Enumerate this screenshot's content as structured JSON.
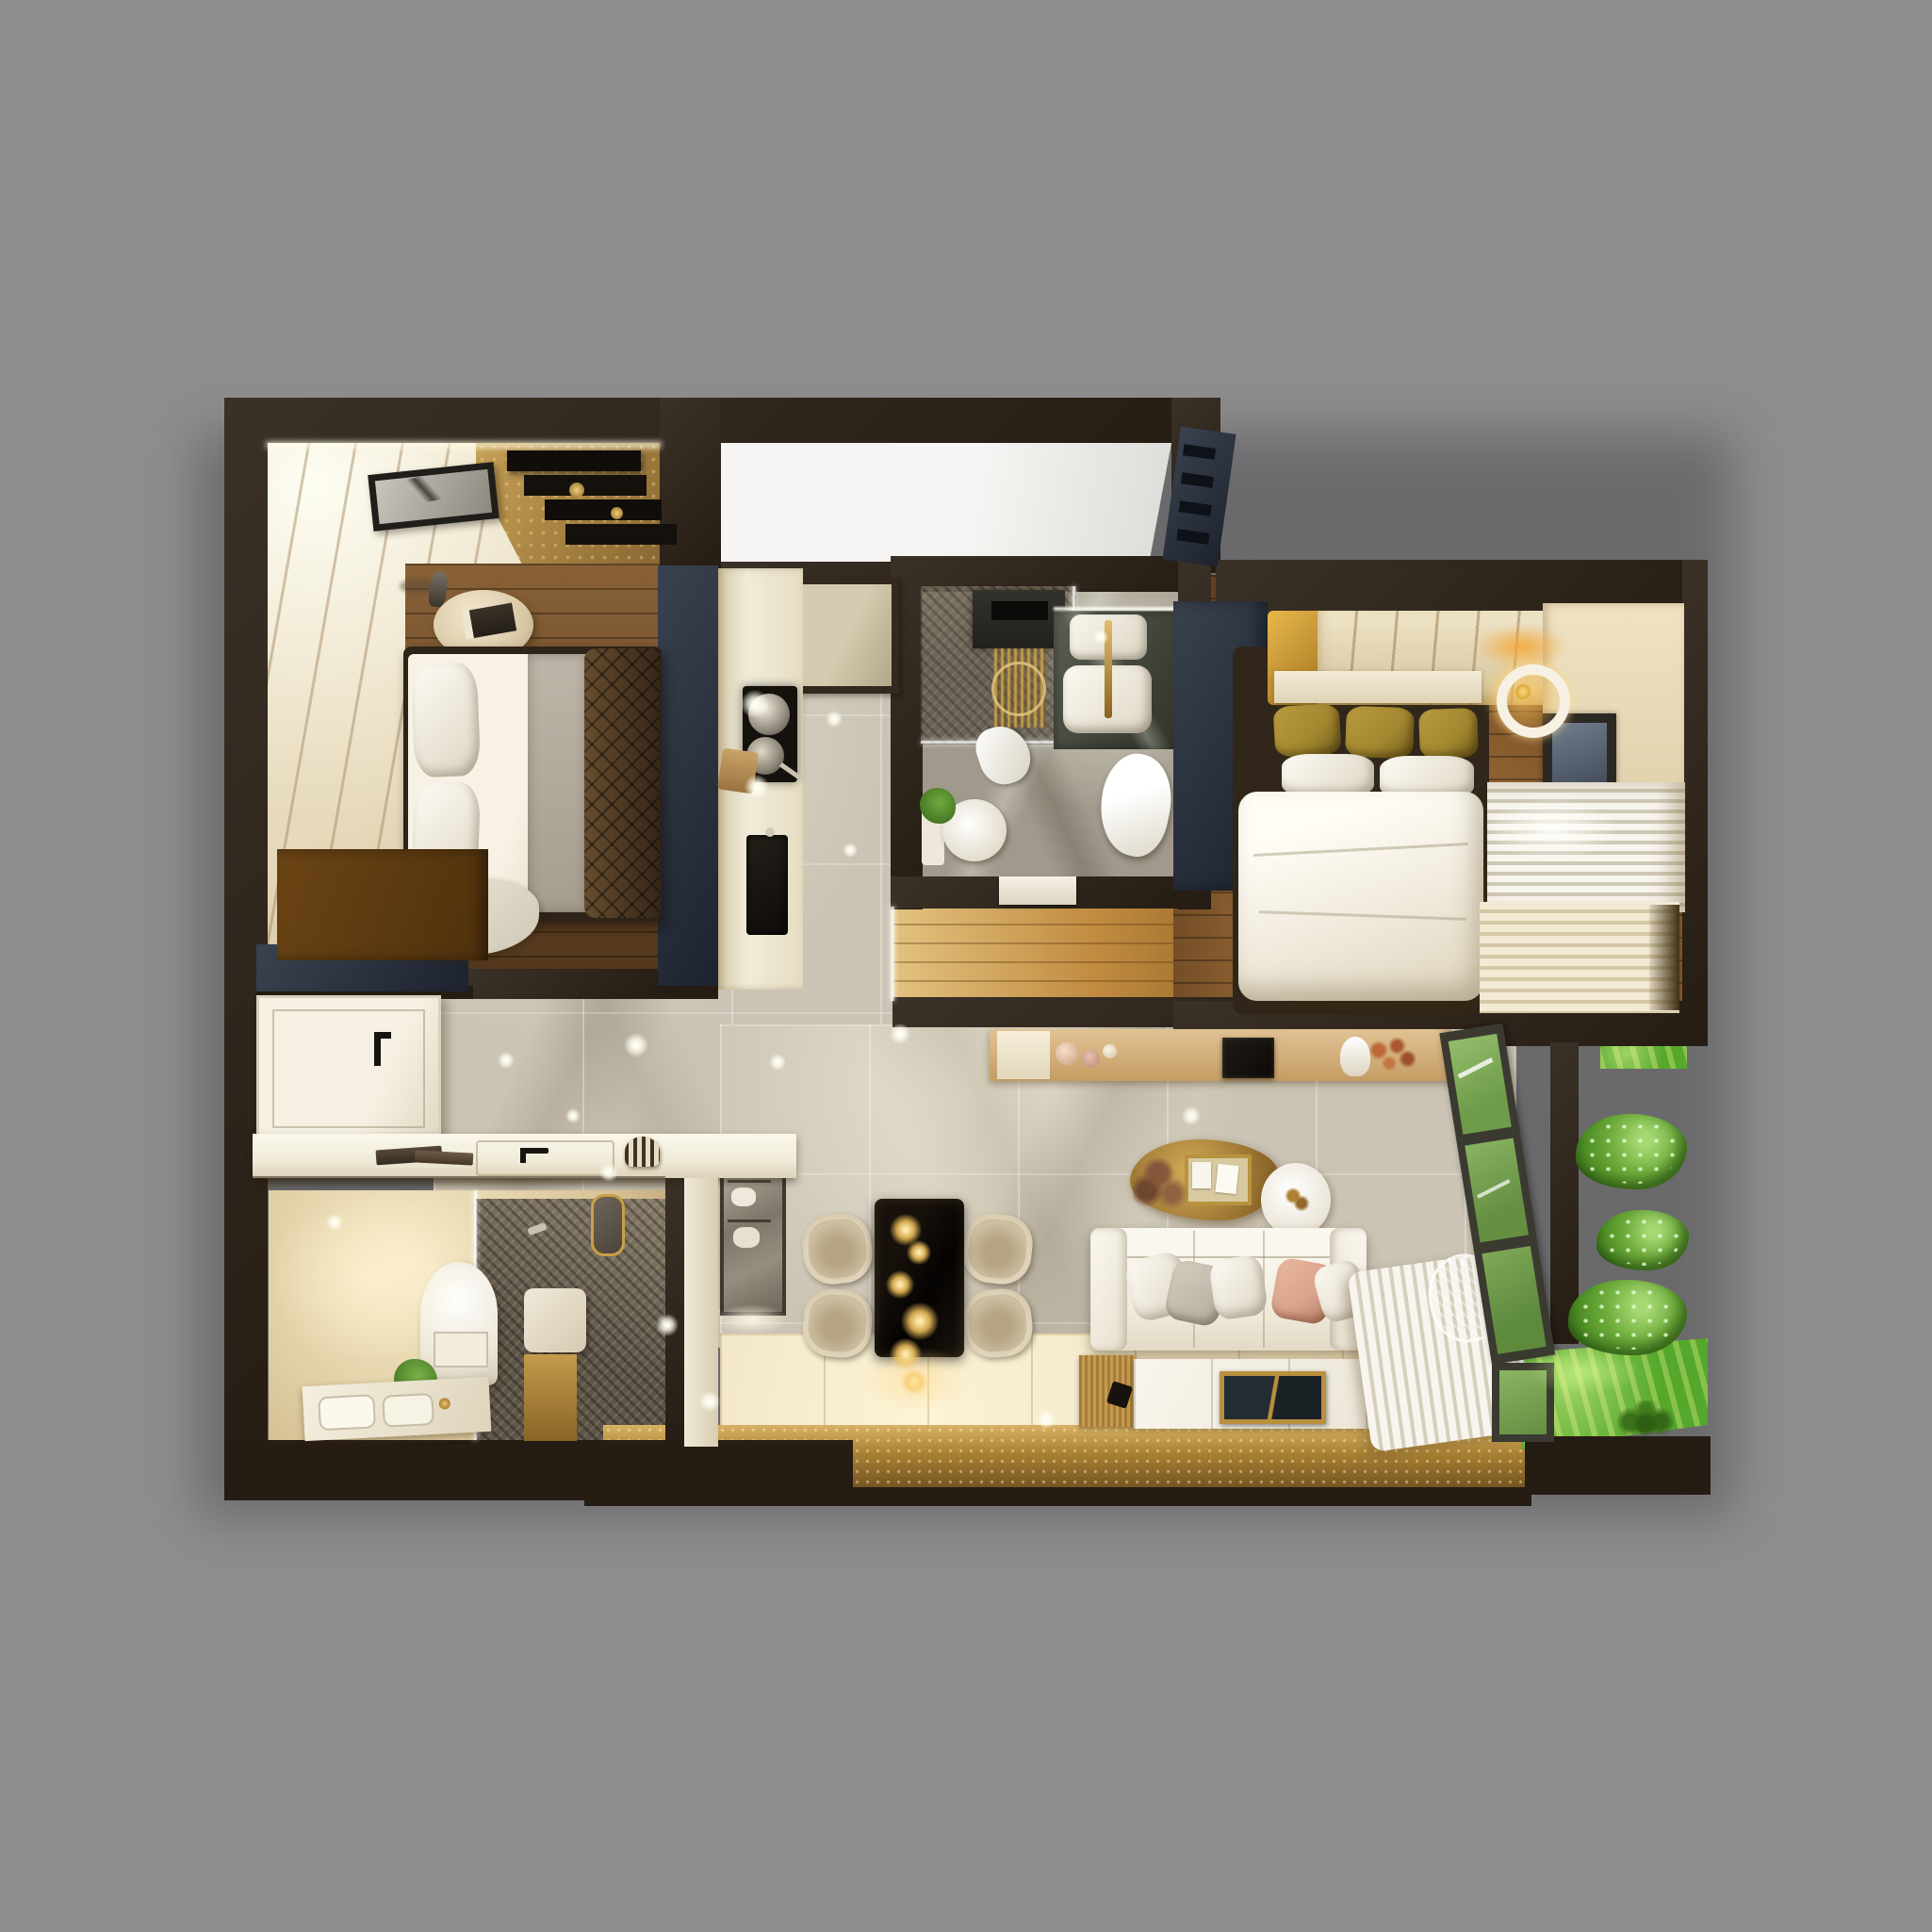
{
  "scene": {
    "title": "Top-down 3D render of a furnished apartment floor plan",
    "description": "Photorealistic dollhouse-style plan view with two bedrooms, two bathrooms, kitchen, hallway, living-dining room and planted balcony on a gray backdrop"
  },
  "palette": {
    "bg": "#8e8e8f",
    "wall": "#3a3127",
    "walldark": "#251c13",
    "navy": "#39424f",
    "navydark": "#1d232e",
    "beige": "#e7dabc",
    "goldcarpet": "#a98445",
    "goldband": "#a87f33",
    "wood": "#6e4a28",
    "masterwood": "#7c5128",
    "corridorwood": "#c08a3f",
    "marble": "#cbc4b4",
    "graytile": "#a19a8c",
    "showerdark": "#5f564a",
    "glow": "#f7ecc9",
    "cream": "#ecdfc0",
    "white": "#f6f2e8",
    "counter": "#f0ebd9",
    "olive": "#a3872f",
    "blush": "#d9a28c",
    "grass": "#55a82b",
    "bush": "#4f8f26",
    "tan": "#d7b686",
    "black": "#14100b",
    "doorwhite": "#f3eee0",
    "glassgreen": "#7fae57"
  },
  "rooms": {
    "bedroom2": {
      "name": "Bedroom 2",
      "furniture": [
        "double bed with brown quilt",
        "white pillows",
        "bedside table with book",
        "table lamp",
        "marble art frame",
        "stepped wall shelf",
        "wardrobe",
        "gold carpet"
      ]
    },
    "entry": {
      "name": "Entry porch",
      "furniture": [
        "white landing",
        "louver AC unit",
        "door mat"
      ]
    },
    "kitchen": {
      "name": "Kitchen",
      "furniture": [
        "tall cabinet run",
        "cooktop with two pans",
        "cutting board",
        "black sink"
      ]
    },
    "bath1": {
      "name": "Bathroom 1",
      "furniture": [
        "rain shower niche",
        "gold shower column",
        "stone vanity with basin",
        "toilet",
        "towels",
        "plant"
      ]
    },
    "master": {
      "name": "Master Bedroom",
      "furniture": [
        "double bed with white duvet",
        "olive pillows",
        "headboard panel",
        "built-in wardrobe",
        "ring pendant lamp",
        "window",
        "pleated curtains"
      ]
    },
    "hall": {
      "name": "Hallway",
      "furniture": [
        "entrance door",
        "marble tiles",
        "oak boards"
      ]
    },
    "living": {
      "name": "Living & Dining Room",
      "furniture": [
        "TV sideboard",
        "television",
        "white sofa with cushions",
        "black dining table",
        "four tub chairs",
        "crystal cascade chandelier",
        "gold wall console with pin board",
        "round wall clock",
        "ribbed gold runner",
        "marble coffee mat with tray",
        "mirrored cabinet",
        "sheer curtain"
      ]
    },
    "bath2": {
      "name": "Bathroom 2",
      "furniture": [
        "toilet",
        "basin counter with gold tap",
        "glass walk-in shower",
        "bench",
        "plant",
        "framed mirror"
      ]
    },
    "balcony": {
      "name": "Balcony",
      "furniture": [
        "lawn",
        "three shrubs",
        "palm plant",
        "wire outdoor chair",
        "glazed window wall"
      ]
    }
  }
}
